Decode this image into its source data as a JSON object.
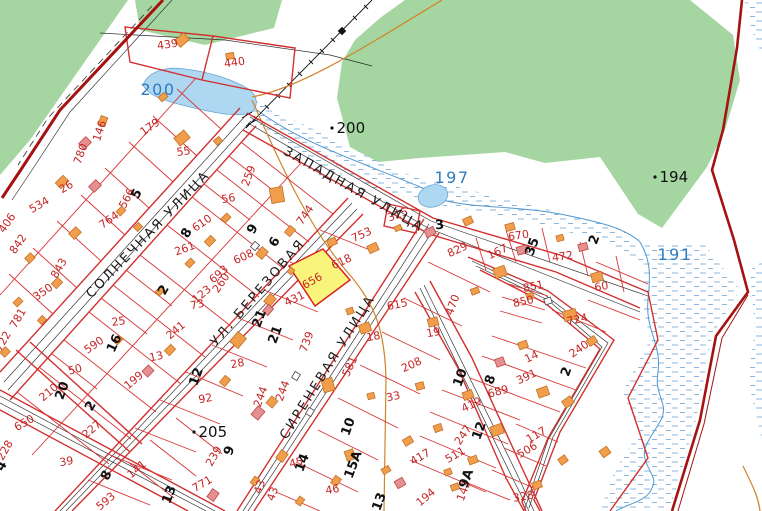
{
  "map": {
    "highlighted_parcel": {
      "number": "656",
      "fill": "#f9f47c",
      "outline": "#dd2222"
    },
    "colors": {
      "forest": "#a5d6a1",
      "water": "#aed7f2",
      "parcel_line": "#d83535",
      "main_road": "#a51212",
      "building": "#f29d4b",
      "masonry_building": "#e49090",
      "parcel_label": "#c42525",
      "water_label": "#2f7cc0"
    },
    "street_labels": [
      {
        "t": "ЗАПАДНАЯ УЛИЦА",
        "x": 352,
        "y": 193,
        "r": 29.5
      },
      {
        "t": "СОЛНЕЧНАЯ УЛИЦА",
        "x": 151,
        "y": 237,
        "r": -46
      },
      {
        "t": "УЛ. БЕРЕЗОВАЯ",
        "x": 261,
        "y": 295,
        "r": -49
      },
      {
        "t": "СИРЕНЕВАЯ УЛИЦА",
        "x": 331,
        "y": 369,
        "r": -58
      }
    ],
    "water_labels": [
      {
        "t": "200",
        "x": 158,
        "y": 95,
        "size": 20
      },
      {
        "t": "197",
        "x": 452,
        "y": 183,
        "size": 16
      },
      {
        "t": "191",
        "x": 675,
        "y": 260,
        "size": 16
      }
    ],
    "elevation_points": [
      {
        "t": "200",
        "x": 332,
        "y": 128,
        "size": 15
      },
      {
        "t": "194",
        "x": 655,
        "y": 177,
        "size": 15
      },
      {
        "t": "205",
        "x": 194,
        "y": 432,
        "size": 16
      }
    ],
    "parcel_labels": [
      {
        "t": "439",
        "x": 168,
        "y": 48,
        "r": -8
      },
      {
        "t": "440",
        "x": 235,
        "y": 66,
        "r": -8
      },
      {
        "t": "146",
        "x": 103,
        "y": 132,
        "r": -72
      },
      {
        "t": "179",
        "x": 152,
        "y": 130,
        "r": -35
      },
      {
        "t": "55",
        "x": 184,
        "y": 155,
        "r": -8
      },
      {
        "t": "780",
        "x": 84,
        "y": 155,
        "r": -70
      },
      {
        "t": "26",
        "x": 68,
        "y": 190,
        "r": -30
      },
      {
        "t": "534",
        "x": 41,
        "y": 208,
        "r": -30
      },
      {
        "t": "566",
        "x": 130,
        "y": 200,
        "r": -62
      },
      {
        "t": "764",
        "x": 111,
        "y": 223,
        "r": -35
      },
      {
        "t": "406",
        "x": 10,
        "y": 225,
        "r": -55
      },
      {
        "t": "842",
        "x": 21,
        "y": 246,
        "r": -55
      },
      {
        "t": "843",
        "x": 62,
        "y": 270,
        "r": -60
      },
      {
        "t": "350",
        "x": 45,
        "y": 295,
        "r": -35
      },
      {
        "t": "781",
        "x": 21,
        "y": 320,
        "r": -60
      },
      {
        "t": "722",
        "x": 6,
        "y": 343,
        "r": -60
      },
      {
        "t": "610",
        "x": 204,
        "y": 226,
        "r": -35
      },
      {
        "t": "261",
        "x": 186,
        "y": 252,
        "r": -20
      },
      {
        "t": "693",
        "x": 221,
        "y": 277,
        "r": -40
      },
      {
        "t": "123",
        "x": 204,
        "y": 297,
        "r": -40
      },
      {
        "t": "73",
        "x": 198,
        "y": 308,
        "r": -12
      },
      {
        "t": "650",
        "x": 26,
        "y": 426,
        "r": -30
      },
      {
        "t": "228",
        "x": 8,
        "y": 452,
        "r": -60
      },
      {
        "t": "210",
        "x": 51,
        "y": 395,
        "r": -40
      },
      {
        "t": "50",
        "x": 76,
        "y": 373,
        "r": -15
      },
      {
        "t": "590",
        "x": 96,
        "y": 348,
        "r": -35
      },
      {
        "t": "25",
        "x": 119,
        "y": 325,
        "r": -8
      },
      {
        "t": "241",
        "x": 178,
        "y": 333,
        "r": -40
      },
      {
        "t": "13",
        "x": 157,
        "y": 360,
        "r": -12
      },
      {
        "t": "199",
        "x": 136,
        "y": 383,
        "r": -40
      },
      {
        "t": "92",
        "x": 206,
        "y": 402,
        "r": -10
      },
      {
        "t": "227",
        "x": 94,
        "y": 432,
        "r": -40
      },
      {
        "t": "39",
        "x": 67,
        "y": 465,
        "r": -10
      },
      {
        "t": "141",
        "x": 139,
        "y": 472,
        "r": -40
      },
      {
        "t": "239",
        "x": 217,
        "y": 458,
        "r": -60
      },
      {
        "t": "771",
        "x": 204,
        "y": 487,
        "r": -30
      },
      {
        "t": "593",
        "x": 108,
        "y": 504,
        "r": -40
      },
      {
        "t": "259",
        "x": 252,
        "y": 177,
        "r": -70
      },
      {
        "t": "56",
        "x": 229,
        "y": 202,
        "r": -10
      },
      {
        "t": "744",
        "x": 308,
        "y": 217,
        "r": -55
      },
      {
        "t": "608",
        "x": 245,
        "y": 260,
        "r": -25
      },
      {
        "t": "260",
        "x": 224,
        "y": 285,
        "r": -55
      },
      {
        "t": "431",
        "x": 296,
        "y": 302,
        "r": -25
      },
      {
        "t": "656",
        "x": 314,
        "y": 284,
        "r": -30
      },
      {
        "t": "618",
        "x": 343,
        "y": 265,
        "r": -25
      },
      {
        "t": "753",
        "x": 363,
        "y": 238,
        "r": -25
      },
      {
        "t": "315",
        "x": 399,
        "y": 218,
        "r": -20
      },
      {
        "t": "615",
        "x": 398,
        "y": 308,
        "r": -12
      },
      {
        "t": "470",
        "x": 456,
        "y": 306,
        "r": -70
      },
      {
        "t": "18",
        "x": 374,
        "y": 340,
        "r": -10
      },
      {
        "t": "19",
        "x": 434,
        "y": 336,
        "r": -10
      },
      {
        "t": "208",
        "x": 413,
        "y": 368,
        "r": -25
      },
      {
        "t": "581",
        "x": 353,
        "y": 368,
        "r": -65
      },
      {
        "t": "33",
        "x": 394,
        "y": 400,
        "r": -12
      },
      {
        "t": "739",
        "x": 310,
        "y": 343,
        "r": -70
      },
      {
        "t": "244",
        "x": 264,
        "y": 398,
        "r": -70
      },
      {
        "t": "244",
        "x": 286,
        "y": 392,
        "r": -70
      },
      {
        "t": "28",
        "x": 238,
        "y": 367,
        "r": -10
      },
      {
        "t": "45",
        "x": 297,
        "y": 466,
        "r": -15
      },
      {
        "t": "46",
        "x": 333,
        "y": 493,
        "r": -10
      },
      {
        "t": "43",
        "x": 263,
        "y": 488,
        "r": -70
      },
      {
        "t": "43",
        "x": 276,
        "y": 495,
        "r": -70
      },
      {
        "t": "417",
        "x": 422,
        "y": 460,
        "r": -30
      },
      {
        "t": "829",
        "x": 459,
        "y": 253,
        "r": -25
      },
      {
        "t": "167",
        "x": 499,
        "y": 255,
        "r": -25
      },
      {
        "t": "670",
        "x": 519,
        "y": 239,
        "r": -8
      },
      {
        "t": "472",
        "x": 563,
        "y": 260,
        "r": -8
      },
      {
        "t": "851",
        "x": 534,
        "y": 290,
        "r": -12
      },
      {
        "t": "850",
        "x": 524,
        "y": 305,
        "r": -12
      },
      {
        "t": "724",
        "x": 578,
        "y": 323,
        "r": -12
      },
      {
        "t": "240",
        "x": 581,
        "y": 352,
        "r": -35
      },
      {
        "t": "60",
        "x": 602,
        "y": 290,
        "r": -10
      },
      {
        "t": "14",
        "x": 533,
        "y": 360,
        "r": -25
      },
      {
        "t": "391",
        "x": 528,
        "y": 380,
        "r": -25
      },
      {
        "t": "689",
        "x": 499,
        "y": 395,
        "r": -15
      },
      {
        "t": "419",
        "x": 473,
        "y": 408,
        "r": -25
      },
      {
        "t": "247",
        "x": 466,
        "y": 437,
        "r": -55
      },
      {
        "t": "511",
        "x": 457,
        "y": 458,
        "r": -30
      },
      {
        "t": "117",
        "x": 538,
        "y": 438,
        "r": -30
      },
      {
        "t": "506",
        "x": 529,
        "y": 453,
        "r": -30
      },
      {
        "t": "143",
        "x": 467,
        "y": 492,
        "r": -70
      },
      {
        "t": "328",
        "x": 524,
        "y": 500,
        "r": -10
      },
      {
        "t": "194",
        "x": 428,
        "y": 500,
        "r": -40
      }
    ],
    "house_numbers": [
      {
        "t": "5",
        "x": 140,
        "y": 196,
        "r": -60
      },
      {
        "t": "8",
        "x": 190,
        "y": 235,
        "r": -60
      },
      {
        "t": "2",
        "x": 167,
        "y": 292,
        "r": -60
      },
      {
        "t": "16",
        "x": 118,
        "y": 345,
        "r": -65
      },
      {
        "t": "20",
        "x": 66,
        "y": 392,
        "r": -70
      },
      {
        "t": "2",
        "x": 94,
        "y": 408,
        "r": -60
      },
      {
        "t": "4",
        "x": 5,
        "y": 468,
        "r": -60
      },
      {
        "t": "8",
        "x": 110,
        "y": 477,
        "r": -65
      },
      {
        "t": "13",
        "x": 173,
        "y": 496,
        "r": -70
      },
      {
        "t": "12",
        "x": 200,
        "y": 378,
        "r": -70
      },
      {
        "t": "9",
        "x": 256,
        "y": 231,
        "r": -60
      },
      {
        "t": "6",
        "x": 278,
        "y": 244,
        "r": -60
      },
      {
        "t": "21",
        "x": 263,
        "y": 320,
        "r": -70
      },
      {
        "t": "21",
        "x": 279,
        "y": 336,
        "r": -70
      },
      {
        "t": "9",
        "x": 233,
        "y": 452,
        "r": -70
      },
      {
        "t": "14",
        "x": 306,
        "y": 464,
        "r": -70
      },
      {
        "t": "15А",
        "x": 357,
        "y": 466,
        "r": -70
      },
      {
        "t": "10",
        "x": 352,
        "y": 428,
        "r": -70
      },
      {
        "t": "3",
        "x": 440,
        "y": 229,
        "r": -5
      },
      {
        "t": "35",
        "x": 536,
        "y": 248,
        "r": -70
      },
      {
        "t": "2",
        "x": 598,
        "y": 241,
        "r": -70
      },
      {
        "t": "10",
        "x": 464,
        "y": 379,
        "r": -70
      },
      {
        "t": "8",
        "x": 494,
        "y": 381,
        "r": -70
      },
      {
        "t": "12",
        "x": 483,
        "y": 432,
        "r": -70
      },
      {
        "t": "9А",
        "x": 470,
        "y": 480,
        "r": -70
      },
      {
        "t": "13",
        "x": 383,
        "y": 503,
        "r": -70
      },
      {
        "t": "2",
        "x": 570,
        "y": 373,
        "r": -70
      }
    ],
    "buildings": [
      [
        182,
        40,
        12,
        9,
        -40,
        "o"
      ],
      [
        230,
        56,
        8,
        6,
        -10,
        "o"
      ],
      [
        103,
        121,
        9,
        7,
        -70,
        "o"
      ],
      [
        163,
        97,
        8,
        6,
        -40,
        "o"
      ],
      [
        85,
        143,
        10,
        8,
        -45,
        "p"
      ],
      [
        182,
        138,
        13,
        10,
        -40,
        "o"
      ],
      [
        218,
        141,
        7,
        6,
        -40,
        "o"
      ],
      [
        62,
        182,
        11,
        8,
        -45,
        "o"
      ],
      [
        95,
        186,
        10,
        8,
        -45,
        "p"
      ],
      [
        121,
        211,
        8,
        6,
        -45,
        "o"
      ],
      [
        138,
        227,
        7,
        6,
        -45,
        "o"
      ],
      [
        75,
        233,
        10,
        8,
        -45,
        "o"
      ],
      [
        30,
        258,
        8,
        7,
        -45,
        "o"
      ],
      [
        57,
        283,
        9,
        7,
        -45,
        "o"
      ],
      [
        18,
        302,
        8,
        6,
        -45,
        "o"
      ],
      [
        42,
        320,
        7,
        6,
        -45,
        "o"
      ],
      [
        5,
        352,
        8,
        7,
        -45,
        "o"
      ],
      [
        118,
        340,
        8,
        6,
        -45,
        "o"
      ],
      [
        170,
        350,
        9,
        7,
        -45,
        "o"
      ],
      [
        148,
        371,
        9,
        8,
        -45,
        "p"
      ],
      [
        277,
        195,
        13,
        15,
        -10,
        "o"
      ],
      [
        226,
        218,
        8,
        6,
        -45,
        "o"
      ],
      [
        210,
        241,
        9,
        7,
        -45,
        "o"
      ],
      [
        190,
        263,
        8,
        6,
        -45,
        "o"
      ],
      [
        160,
        291,
        8,
        6,
        -45,
        "o"
      ],
      [
        290,
        231,
        9,
        7,
        -50,
        "o"
      ],
      [
        262,
        253,
        10,
        8,
        -50,
        "o"
      ],
      [
        255,
        246,
        7,
        6,
        -50,
        "w"
      ],
      [
        291,
        271,
        6,
        5,
        -50,
        "o"
      ],
      [
        270,
        300,
        10,
        8,
        -50,
        "o"
      ],
      [
        268,
        310,
        9,
        7,
        -50,
        "p"
      ],
      [
        238,
        340,
        13,
        11,
        -50,
        "o"
      ],
      [
        225,
        381,
        9,
        7,
        -50,
        "o"
      ],
      [
        328,
        385,
        11,
        13,
        -15,
        "o"
      ],
      [
        296,
        376,
        7,
        6,
        -60,
        "w"
      ],
      [
        310,
        412,
        7,
        6,
        -60,
        "w"
      ],
      [
        272,
        402,
        9,
        8,
        -50,
        "o"
      ],
      [
        258,
        413,
        11,
        9,
        -50,
        "p"
      ],
      [
        282,
        456,
        10,
        8,
        -55,
        "o"
      ],
      [
        336,
        481,
        9,
        7,
        -55,
        "o"
      ],
      [
        255,
        481,
        8,
        6,
        -55,
        "o"
      ],
      [
        213,
        495,
        10,
        8,
        -55,
        "p"
      ],
      [
        300,
        501,
        8,
        6,
        -55,
        "o"
      ],
      [
        332,
        242,
        9,
        7,
        -25,
        "o"
      ],
      [
        373,
        248,
        10,
        8,
        -25,
        "o"
      ],
      [
        398,
        228,
        7,
        5,
        -25,
        "o"
      ],
      [
        365,
        328,
        11,
        9,
        -20,
        "o"
      ],
      [
        350,
        311,
        7,
        6,
        -20,
        "o"
      ],
      [
        433,
        322,
        10,
        8,
        -15,
        "o"
      ],
      [
        420,
        386,
        8,
        7,
        -15,
        "o"
      ],
      [
        371,
        396,
        7,
        6,
        -15,
        "o"
      ],
      [
        350,
        455,
        9,
        10,
        -20,
        "o"
      ],
      [
        408,
        441,
        9,
        7,
        -30,
        "o"
      ],
      [
        386,
        470,
        8,
        6,
        -30,
        "o"
      ],
      [
        400,
        483,
        9,
        8,
        -30,
        "p"
      ],
      [
        430,
        232,
        10,
        8,
        -25,
        "p"
      ],
      [
        468,
        221,
        9,
        7,
        -25,
        "o"
      ],
      [
        510,
        227,
        9,
        7,
        -15,
        "o"
      ],
      [
        522,
        250,
        10,
        8,
        -15,
        "p"
      ],
      [
        560,
        238,
        7,
        6,
        -15,
        "o"
      ],
      [
        583,
        247,
        9,
        7,
        -15,
        "p"
      ],
      [
        500,
        272,
        12,
        10,
        -20,
        "o"
      ],
      [
        475,
        291,
        8,
        6,
        -20,
        "o"
      ],
      [
        597,
        277,
        11,
        9,
        -15,
        "o"
      ],
      [
        530,
        296,
        7,
        6,
        -20,
        "o"
      ],
      [
        548,
        301,
        7,
        6,
        -20,
        "w"
      ],
      [
        570,
        315,
        13,
        10,
        -15,
        "o"
      ],
      [
        592,
        341,
        9,
        7,
        -35,
        "o"
      ],
      [
        568,
        402,
        10,
        8,
        -35,
        "o"
      ],
      [
        563,
        460,
        8,
        7,
        -35,
        "o"
      ],
      [
        605,
        452,
        9,
        8,
        -35,
        "o"
      ],
      [
        523,
        345,
        9,
        7,
        -20,
        "o"
      ],
      [
        500,
        362,
        9,
        8,
        -20,
        "p"
      ],
      [
        543,
        392,
        11,
        9,
        -20,
        "o"
      ],
      [
        468,
        395,
        10,
        8,
        -20,
        "o"
      ],
      [
        438,
        428,
        8,
        7,
        -20,
        "o"
      ],
      [
        497,
        430,
        12,
        10,
        -20,
        "o"
      ],
      [
        473,
        460,
        9,
        7,
        -20,
        "o"
      ],
      [
        537,
        485,
        9,
        7,
        -20,
        "o"
      ],
      [
        448,
        472,
        7,
        6,
        -20,
        "o"
      ],
      [
        455,
        487,
        8,
        6,
        -20,
        "o"
      ]
    ]
  }
}
